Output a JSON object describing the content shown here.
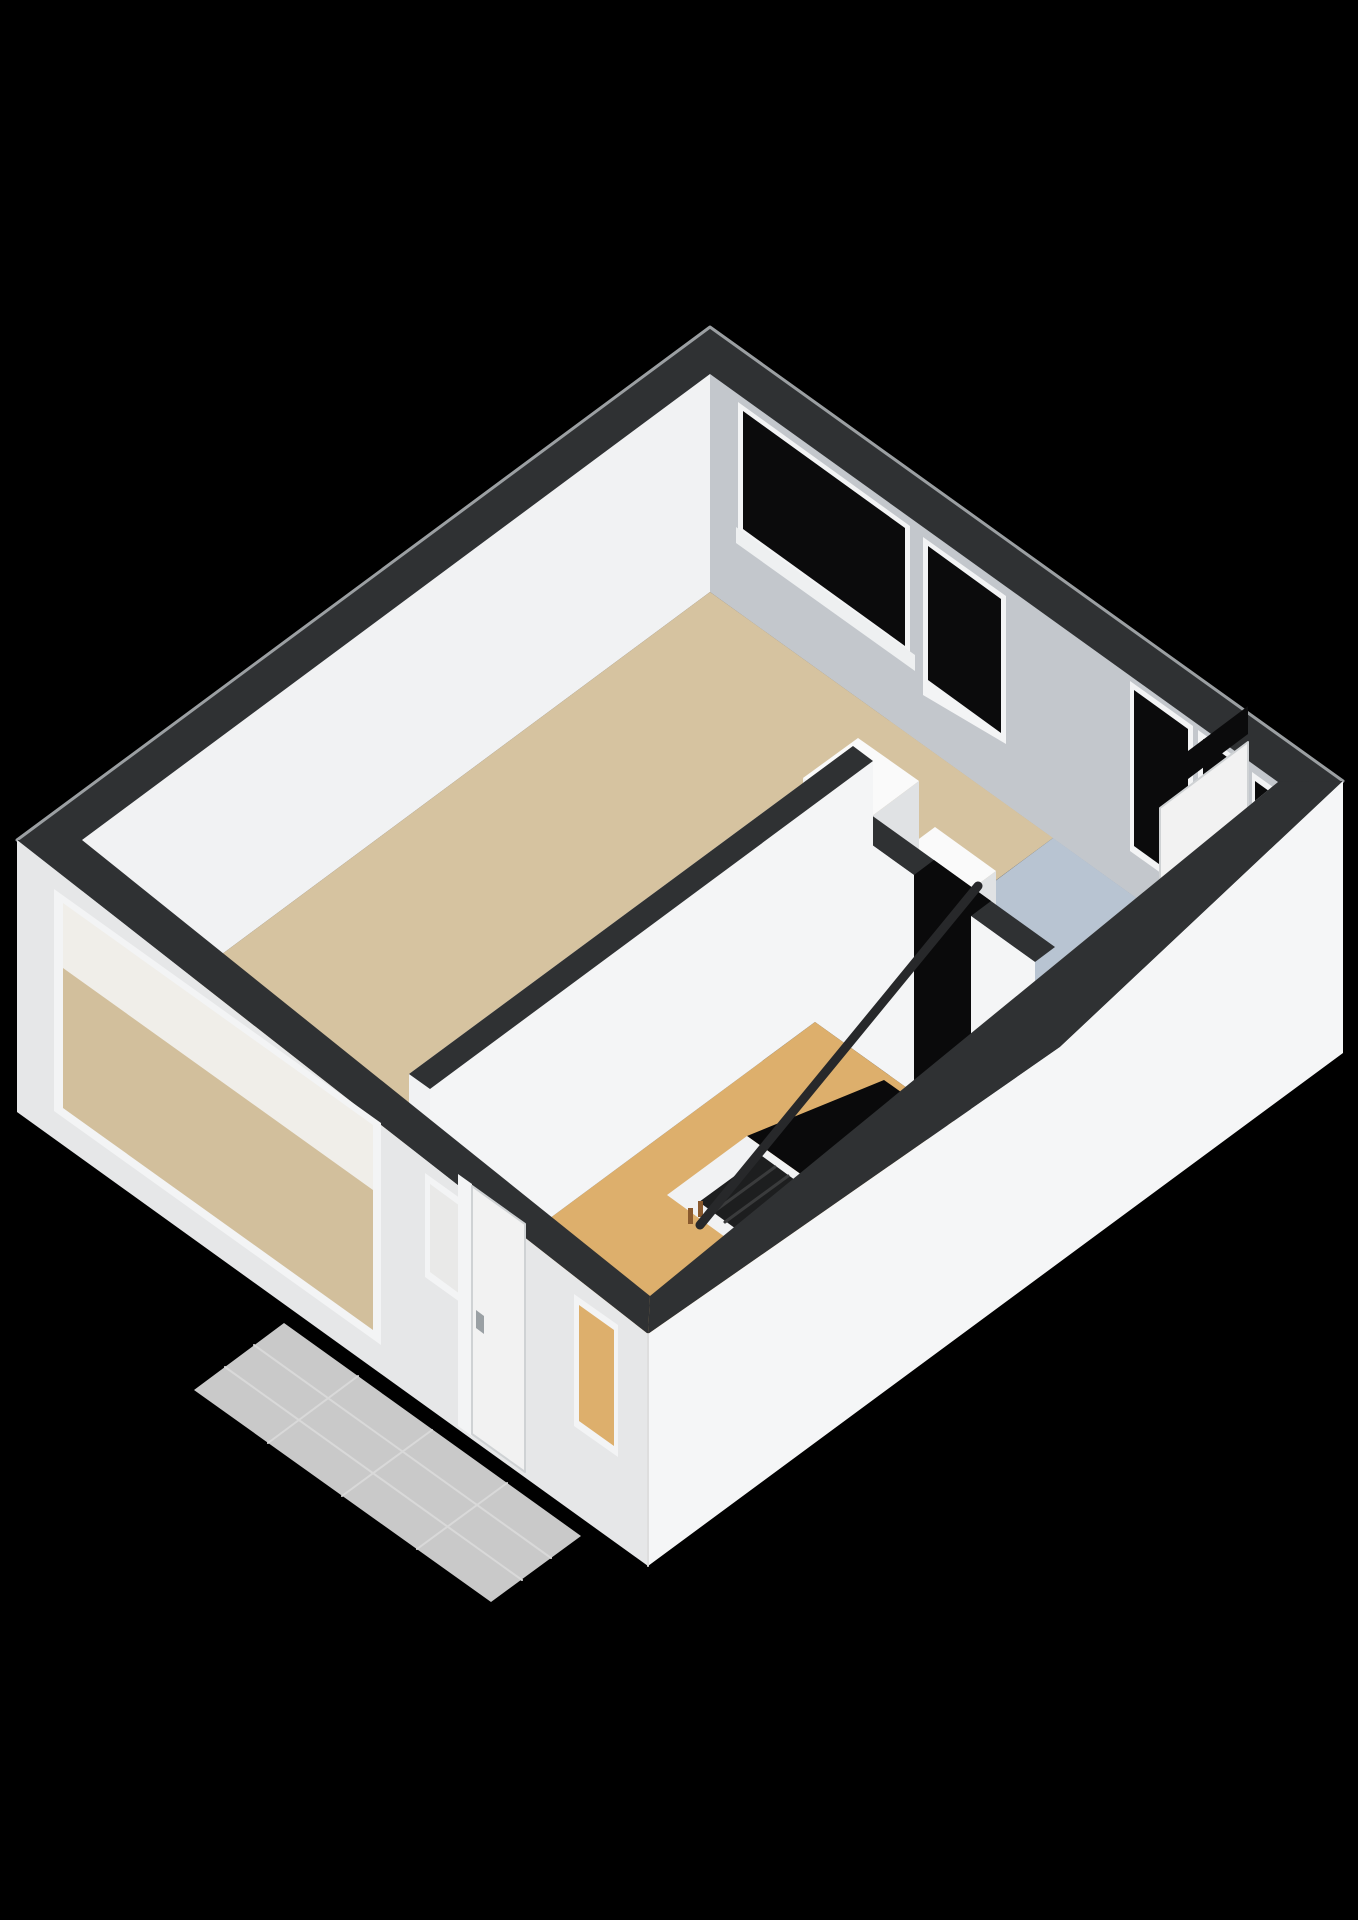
{
  "scene": {
    "width": 1358,
    "height": 1920,
    "background": "#000000",
    "colors": {
      "band": "#2f3133",
      "bandEdge": "#9b9fa2",
      "neFace": "#c3c7cc",
      "nwFace": "#f1f2f3",
      "seIntFace": "#e9ebed",
      "livingFloor": "#d6c3a0",
      "blueFloor": "#b8c4d2",
      "hallFloor": "#ddaf6c",
      "glass": "#0b0b0c",
      "frame": "#f3f4f5",
      "sill": "#eef0f1",
      "extSW": "#e6e7e8",
      "extSE": "#f5f6f7",
      "porch": "#c9c9c9",
      "porchJoint": "#d9d9d9",
      "voidBlack": "#0a0a0b",
      "stepDark": "#1d1e1f",
      "stepEdge": "#3a3b3c",
      "baluster": "#8a5a2e",
      "boxTop": "#fafafa",
      "boxLight": "#f1f2f3",
      "boxShade": "#e0e2e4",
      "rail": "#27282a",
      "doorLeaf": "#f2f2f2",
      "doorEdge": "#cfd2d4",
      "handle": "#9aa0a4",
      "frostedGlass": "#e9e9e8",
      "throughBeige": "#d2bf9c",
      "throughWhite": "#f0eee9",
      "wallWhite": "#f4f5f6",
      "cornerEdge": "#dedede"
    },
    "shapes": [
      {
        "name": "wall-top-band",
        "type": "polygon",
        "points": "710,327 1343,781 1060,1047 648,1334 17,840",
        "fill": "band",
        "stroke": "bandEdge",
        "stroke_width": 3
      },
      {
        "name": "ne-interior-wall",
        "type": "polygon",
        "points": "710,374 1278,782 1278,1000 710,592",
        "fill": "neFace"
      },
      {
        "name": "window-1-frame",
        "type": "polygon",
        "points": "738,402 910,526 910,658 738,534",
        "fill": "frame"
      },
      {
        "name": "window-1-glass",
        "type": "polygon",
        "points": "743,411 905,528 905,646 743,529",
        "fill": "glass"
      },
      {
        "name": "window-1-sill",
        "type": "polygon",
        "points": "736,527 915,655 915,671 736,543",
        "fill": "sill"
      },
      {
        "name": "window-2-frame",
        "type": "polygon",
        "points": "923,537 1006,596 1006,744 923,695",
        "fill": "frame"
      },
      {
        "name": "window-2-glass",
        "type": "polygon",
        "points": "928,546 1001,599 1001,733 928,680",
        "fill": "glass"
      },
      {
        "name": "window-3-frame",
        "type": "polygon",
        "points": "1130,681 1193,726 1193,896 1130,851",
        "fill": "frame"
      },
      {
        "name": "window-3-glass",
        "type": "polygon",
        "points": "1134,690 1188,729 1188,885 1134,846",
        "fill": "glass"
      },
      {
        "name": "balcony-door-frame",
        "type": "polygon",
        "points": "1198,730 1248,766 1248,976 1198,940",
        "fill": "frame"
      },
      {
        "name": "balcony-door-transom-glass",
        "type": "polygon",
        "points": "1203,739 1243,769 1243,811 1203,781",
        "fill": "glass"
      },
      {
        "name": "balcony-door-glass",
        "type": "polygon",
        "points": "1203,791 1243,821 1243,907 1203,877",
        "fill": "glass"
      },
      {
        "name": "window-4-frame",
        "type": "polygon",
        "points": "1252,772 1277,790 1277,872 1252,854",
        "fill": "frame"
      },
      {
        "name": "window-4-glass",
        "type": "polygon",
        "points": "1255,781 1273,794 1273,862 1255,849",
        "fill": "glass"
      },
      {
        "name": "nw-interior-wall",
        "type": "polygon",
        "points": "710,374 82,840 82,1058 710,592",
        "fill": "nwFace"
      },
      {
        "name": "living-room-floor",
        "type": "polygon",
        "points": "710,592 1053,838 868,975 853,964 409,1292 82,1058",
        "fill": "livingFloor"
      },
      {
        "name": "blue-room-floor",
        "type": "polygon",
        "points": "1053,838 1278,1000 1055,1165 830,1004",
        "fill": "blueFloor"
      },
      {
        "name": "se-interior-wall",
        "type": "polygon",
        "points": "1278,782 650,1296 650,1514 1278,1000",
        "fill": "seIntFace"
      },
      {
        "name": "se-door-transom",
        "type": "polygon",
        "points": "1248,706 1160,772 1160,800 1248,734",
        "fill": "glass"
      },
      {
        "name": "se-door-leaf",
        "type": "polygon",
        "points": "1248,742 1160,808 1160,942 1248,876",
        "fill": "doorLeaf",
        "stroke": "doorEdge",
        "stroke_width": 2
      },
      {
        "name": "se-door-handle",
        "type": "polygon",
        "points": "1170,912 1177,907 1177,923 1170,928",
        "fill": "handle"
      },
      {
        "name": "cabinet-east-top",
        "type": "polygon",
        "points": "935,827 996,871 942,911 881,867",
        "fill": "boxTop"
      },
      {
        "name": "cabinet-east-front",
        "type": "polygon",
        "points": "881,867 942,911 942,1019 881,975",
        "fill": "boxLight"
      },
      {
        "name": "cabinet-east-side",
        "type": "polygon",
        "points": "942,911 996,871 996,979 942,1019",
        "fill": "boxShade"
      },
      {
        "name": "cabinet-west-top",
        "type": "polygon",
        "points": "858,738 919,781 864,822 803,778",
        "fill": "boxTop"
      },
      {
        "name": "cabinet-west-front",
        "type": "polygon",
        "points": "803,778 864,822 864,970 803,926",
        "fill": "boxLight"
      },
      {
        "name": "cabinet-west-side",
        "type": "polygon",
        "points": "864,822 919,781 919,929 864,970",
        "fill": "boxShade"
      },
      {
        "name": "partition-blue-top",
        "type": "polygon",
        "points": "835,789 1055,947 1035,962 815,804",
        "fill": "band"
      },
      {
        "name": "partition-blue-face-a",
        "type": "polygon",
        "points": "815,804 914,875 914,1093 815,1022",
        "fill": "wallWhite"
      },
      {
        "name": "partition-blue-face-b",
        "type": "polygon",
        "points": "971,916 1035,962 1035,1180 971,1134",
        "fill": "wallWhite"
      },
      {
        "name": "stair-head-opening",
        "type": "polygon",
        "points": "934,860 991,901 971,916 971,1134 914,1093 914,875",
        "fill": "voidBlack"
      },
      {
        "name": "hallway-floor",
        "type": "polygon",
        "points": "815,1022 1035,1180 650,1465 430,1307",
        "fill": "hallFloor"
      },
      {
        "name": "stair-void",
        "type": "polygon",
        "points": "884,1080 953,1129 816,1185 747,1136",
        "fill": "voidBlack"
      },
      {
        "name": "stair-enclosure",
        "type": "polygon",
        "points": "747,1136 816,1185 736,1245 667,1195",
        "fill": "boxLight"
      },
      {
        "name": "stair-steps",
        "type": "polygon",
        "points": "762,1156 806,1188 743,1234 699,1202",
        "fill": "stepDark"
      },
      {
        "name": "stair-step-edge-1",
        "type": "line",
        "points": "775,1167 712,1213",
        "stroke": "stepEdge",
        "stroke_width": 3
      },
      {
        "name": "stair-step-edge-2",
        "type": "line",
        "points": "788,1176 725,1222",
        "stroke": "stepEdge",
        "stroke_width": 3
      },
      {
        "name": "stair-baluster-1",
        "type": "polygon",
        "points": "688,1208 693,1208 693,1224 688,1224",
        "fill": "baluster"
      },
      {
        "name": "stair-baluster-2",
        "type": "polygon",
        "points": "698,1201 703,1201 703,1217 698,1217",
        "fill": "baluster"
      },
      {
        "name": "stair-handrail",
        "type": "line",
        "points": "978,886 700,1225",
        "stroke": "rail",
        "stroke_width": 9
      },
      {
        "name": "living-partition-face-west",
        "type": "polygon",
        "points": "853,746 409,1074 409,1292 853,964",
        "fill": "boxLight"
      },
      {
        "name": "living-door-leaf",
        "type": "polygon",
        "points": "728,878 668,923 668,1101 728,1056",
        "fill": "doorLeaf",
        "stroke": "doorEdge",
        "stroke_width": 2
      },
      {
        "name": "living-door-handle",
        "type": "polygon",
        "points": "705,1025 713,1020 713,1036 705,1041",
        "fill": "handle"
      },
      {
        "name": "living-partition-face-east",
        "type": "polygon",
        "points": "873,761 430,1089 430,1307 873,979",
        "fill": "wallWhite"
      },
      {
        "name": "living-partition-top",
        "type": "polygon",
        "points": "853,746 873,761 430,1089 409,1074",
        "fill": "band"
      },
      {
        "name": "porch-tiles",
        "type": "polygon",
        "points": "284,1323 581,1536 491,1602 194,1390",
        "fill": "porch"
      },
      {
        "name": "porch-joint-1",
        "type": "line",
        "points": "254,1345 551,1558",
        "stroke": "porchJoint",
        "stroke_width": 2
      },
      {
        "name": "porch-joint-2",
        "type": "line",
        "points": "225,1367 522,1580",
        "stroke": "porchJoint",
        "stroke_width": 2
      },
      {
        "name": "porch-joint-3",
        "type": "line",
        "points": "358,1376 268,1443",
        "stroke": "porchJoint",
        "stroke_width": 2
      },
      {
        "name": "porch-joint-4",
        "type": "line",
        "points": "432,1430 342,1496",
        "stroke": "porchJoint",
        "stroke_width": 2
      },
      {
        "name": "porch-joint-5",
        "type": "line",
        "points": "507,1483 417,1549",
        "stroke": "porchJoint",
        "stroke_width": 2
      },
      {
        "name": "band-strip-sw",
        "type": "polygon",
        "points": "17,840 82,840 650,1296 648,1334",
        "fill": "band"
      },
      {
        "name": "band-strip-se",
        "type": "polygon",
        "points": "1343,781 1060,1047 648,1334 650,1296 1278,782",
        "fill": "band"
      },
      {
        "name": "sw-exterior-wall",
        "type": "polygon",
        "points": "17,840 648,1334 648,1566 17,1112",
        "fill": "extSW"
      },
      {
        "name": "sw-window-frame",
        "type": "polygon",
        "points": "54,889 381,1123 381,1345 54,1111",
        "fill": "frame"
      },
      {
        "name": "sw-window-upper-view",
        "type": "polygon",
        "points": "63,903 373,1125 373,1190 63,968",
        "fill": "throughWhite"
      },
      {
        "name": "sw-window-floor-view",
        "type": "polygon",
        "points": "63,968 373,1190 373,1330 63,1108",
        "fill": "throughBeige"
      },
      {
        "name": "entry-window-frame",
        "type": "polygon",
        "points": "425,1173 464,1201 464,1305 425,1277",
        "fill": "frame"
      },
      {
        "name": "entry-window-glass",
        "type": "polygon",
        "points": "430,1184 460,1206 460,1294 430,1272",
        "fill": "frostedGlass"
      },
      {
        "name": "front-door-trim",
        "type": "polygon",
        "points": "458,1174 472,1184 472,1436 458,1426",
        "fill": "frame"
      },
      {
        "name": "front-door",
        "type": "polygon",
        "points": "472,1186 525,1224 525,1472 472,1434",
        "fill": "doorLeaf",
        "stroke": "doorEdge",
        "stroke_width": 2
      },
      {
        "name": "front-door-handle",
        "type": "polygon",
        "points": "476,1310 484,1316 484,1334 476,1328",
        "fill": "handle"
      },
      {
        "name": "hall-window-frame",
        "type": "polygon",
        "points": "574,1294 618,1325 618,1457 574,1426",
        "fill": "frame"
      },
      {
        "name": "hall-window-view",
        "type": "polygon",
        "points": "579,1305 614,1330 614,1446 579,1421",
        "fill": "hallFloor"
      },
      {
        "name": "se-exterior-wall",
        "type": "polygon",
        "points": "1343,781 1060,1047 648,1334 648,1566 1343,1053",
        "fill": "extSE"
      },
      {
        "name": "exterior-corner-edge",
        "type": "line",
        "points": "648,1334 648,1566",
        "stroke": "cornerEdge",
        "stroke_width": 2
      }
    ]
  }
}
